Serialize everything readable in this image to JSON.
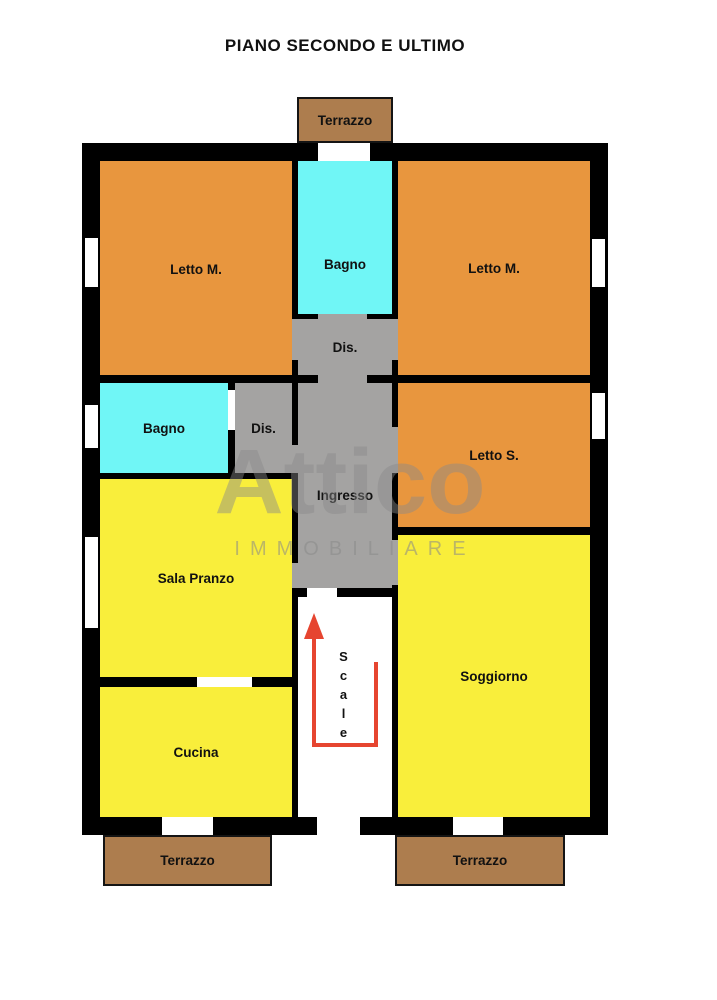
{
  "title": "PIANO SECONDO E ULTIMO",
  "watermark": {
    "logo_text": "Attico",
    "subtitle": "IMMOBILIARE"
  },
  "scale_arrow": {
    "direction": "up"
  },
  "colors": {
    "room_orange": "#e8963e",
    "room_yellow": "#f9ee3b",
    "room_cyan": "#70f6f6",
    "room_gray": "#a4a3a2",
    "terrace_brown": "#ad7d4e",
    "wall_black": "#000000",
    "stairs_red": "#e64530",
    "wm": "#8a8a8a"
  },
  "rooms": {
    "terrazzo_top": {
      "label": "Terrazzo"
    },
    "letto_m_left": {
      "label": "Letto M."
    },
    "bagno_top": {
      "label": "Bagno"
    },
    "letto_m_right": {
      "label": "Letto M."
    },
    "dis_top": {
      "label": "Dis."
    },
    "bagno_left": {
      "label": "Bagno"
    },
    "dis_left": {
      "label": "Dis."
    },
    "letto_s": {
      "label": "Letto S."
    },
    "ingresso": {
      "label": "Ingresso"
    },
    "sala_pranzo": {
      "label": "Sala Pranzo"
    },
    "cucina": {
      "label": "Cucina"
    },
    "soggiorno": {
      "label": "Soggiorno"
    },
    "scale": {
      "label": "Scale"
    },
    "terrazzo_bottom_left": {
      "label": "Terrazzo"
    },
    "terrazzo_bottom_right": {
      "label": "Terrazzo"
    }
  }
}
